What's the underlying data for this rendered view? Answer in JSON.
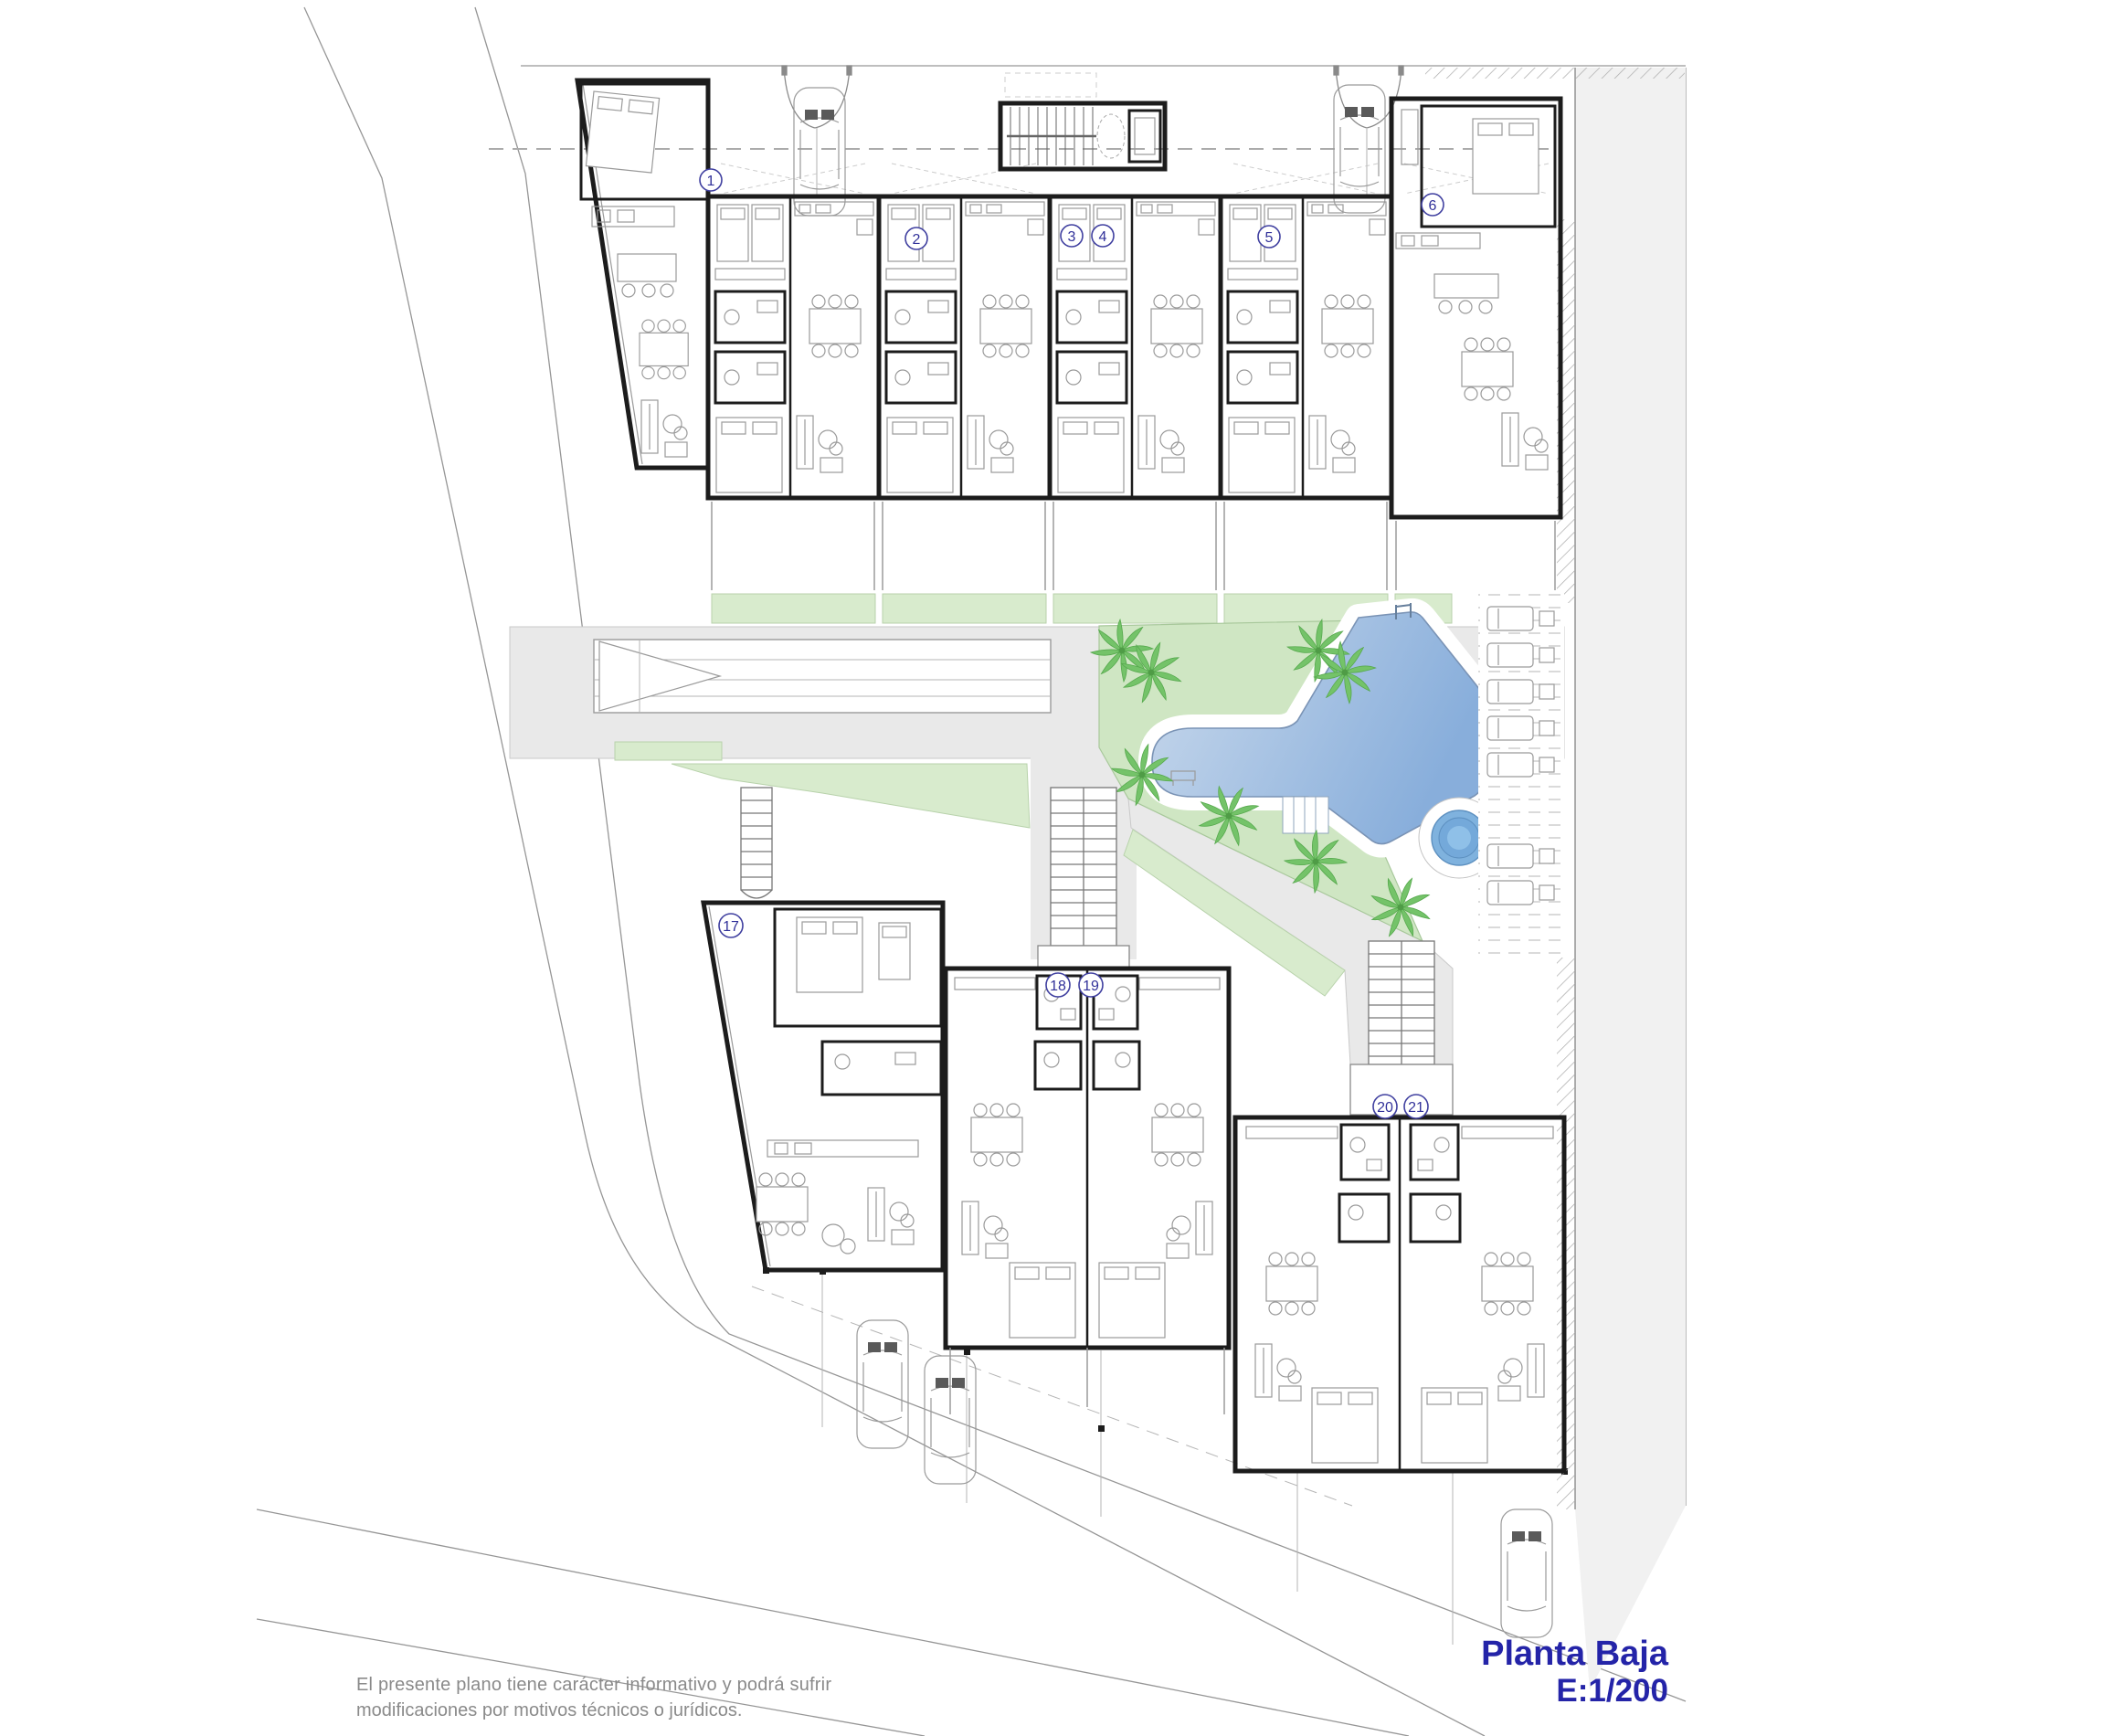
{
  "title_block": {
    "title": "Planta Baja",
    "scale": "E:1/200"
  },
  "disclaimer": {
    "line1": "El presente plano tiene carácter informativo y podrá sufrir",
    "line2": "modificaciones por motivos técnicos o jurídicos."
  },
  "units": [
    {
      "label": "1"
    },
    {
      "label": "2"
    },
    {
      "label": "3"
    },
    {
      "label": "4"
    },
    {
      "label": "5"
    },
    {
      "label": "6"
    },
    {
      "label": "17"
    },
    {
      "label": "18"
    },
    {
      "label": "19"
    },
    {
      "label": "20"
    },
    {
      "label": "21"
    }
  ],
  "features": {
    "pool": "swimming-pool",
    "spa": "circular-spa",
    "lawn": "garden-lawn",
    "palms": "palm-trees",
    "loungers": "sun-lounger-deck",
    "ramp": "parking-ramp",
    "cars": "parked-cars",
    "stairs": "communal-stairs"
  },
  "colors": {
    "lawn": "#cfe6c3",
    "green_strip": "#d8ebcd",
    "pool_light": "#c9d9ec",
    "pool_deep": "#88aedb",
    "spa": "#7fb2de",
    "walkway": "#e9e9e9",
    "sidewalk": "#f1f1f1",
    "palm": "#74c369",
    "wall": "#1c1c1c",
    "label_blue": "#31319a",
    "title_blue": "#2424a8"
  }
}
